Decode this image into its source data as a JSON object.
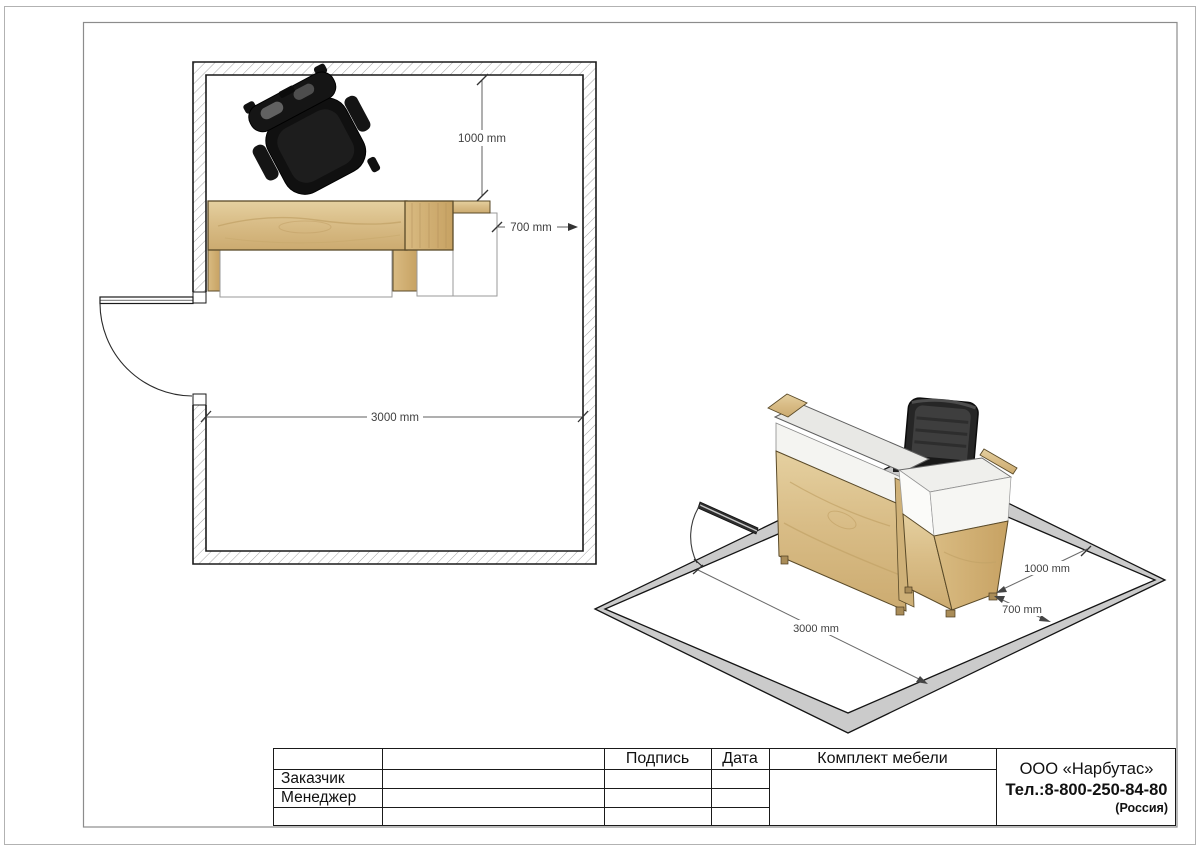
{
  "document": {
    "type": "furniture-layout-drawing",
    "views": [
      "floor-plan",
      "isometric"
    ]
  },
  "plan_view": {
    "dims": {
      "top_clearance": "1000 mm",
      "side_clearance": "700 mm",
      "room_width": "3000 mm"
    }
  },
  "iso_view": {
    "dims": {
      "room_width": "3000 mm",
      "back_clearance": "1000 mm",
      "side_clearance": "700 mm"
    }
  },
  "title_block": {
    "signature_label": "Подпись",
    "date_label": "Дата",
    "customer_label": "Заказчик",
    "manager_label": "Менеджер",
    "furniture_set_label": "Комплект мебели",
    "company_name": "ООО «Нарбутас»",
    "company_phone": "Тел.:8-800-250-84-80",
    "company_country": "(Россия)"
  },
  "colors": {
    "wood": "#d9bd87",
    "wood_dark": "#c9a96b",
    "wood_outline": "#5a4a28",
    "desk_surface": "#efefec",
    "wall_band_gray": "#cbcbcb",
    "drawing_line": "#1a1a1a",
    "dim_text": "#3f3f3f",
    "chair_black": "#151515"
  }
}
